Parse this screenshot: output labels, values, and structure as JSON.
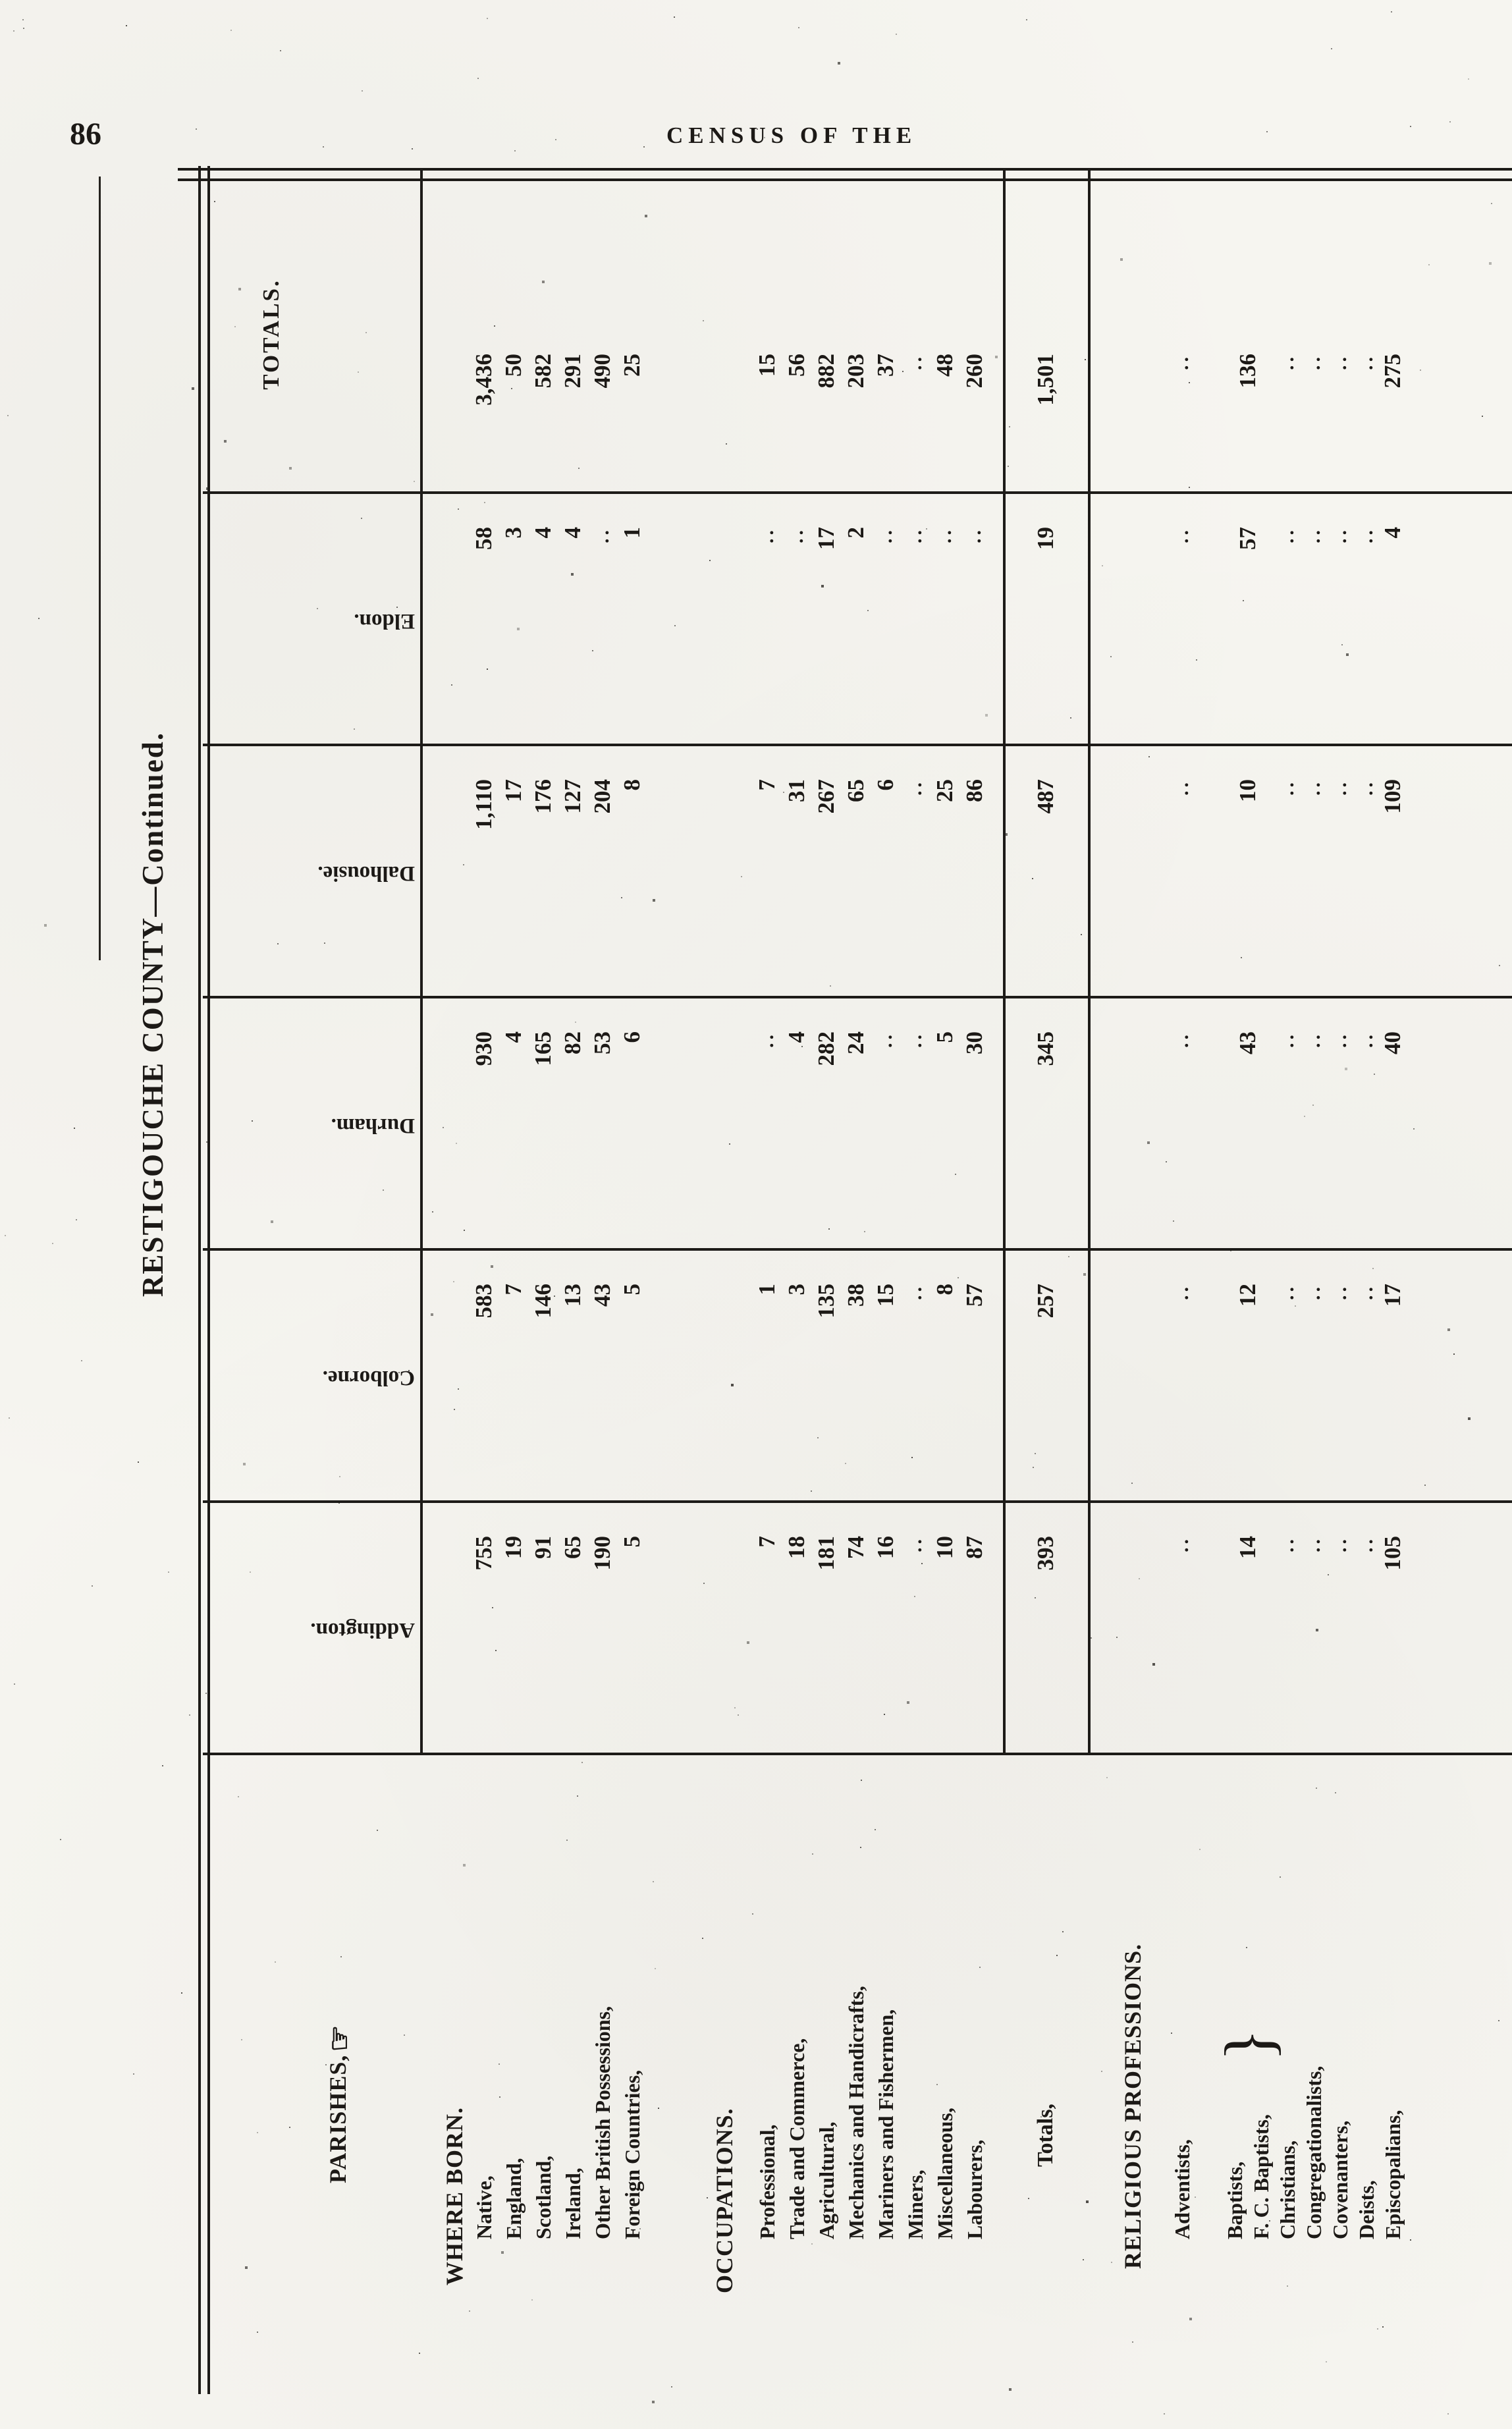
{
  "page": {
    "number": "86",
    "running_header": "CENSUS OF THE",
    "table_title": "RESTIGOUCHE COUNTY—Continued."
  },
  "table": {
    "parishes_label": "PARISHES,",
    "manicule": "☞",
    "blank_marker": "..",
    "brace_glyph": "}",
    "columns": [
      "Addington.",
      "Colborne.",
      "Durham.",
      "Dalhousie.",
      "Eldon.",
      "TOTALS."
    ],
    "sections": [
      {
        "title": "WHERE BORN.",
        "rows": [
          {
            "label": "Native,",
            "values": [
              "755",
              "583",
              "930",
              "1,110",
              "58",
              "3,436"
            ]
          },
          {
            "label": "England,",
            "values": [
              "19",
              "7",
              "4",
              "17",
              "3",
              "50"
            ]
          },
          {
            "label": "Scotland,",
            "values": [
              "91",
              "146",
              "165",
              "176",
              "4",
              "582"
            ]
          },
          {
            "label": "Ireland,",
            "values": [
              "65",
              "13",
              "82",
              "127",
              "4",
              "291"
            ]
          },
          {
            "label": "Other British Possessions,",
            "values": [
              "190",
              "43",
              "53",
              "204",
              "..",
              "490"
            ]
          },
          {
            "label": "Foreign Countries,",
            "values": [
              "5",
              "5",
              "6",
              "8",
              "1",
              "25"
            ]
          }
        ]
      },
      {
        "title": "OCCUPATIONS.",
        "rows": [
          {
            "label": "Professional,",
            "values": [
              "7",
              "1",
              "..",
              "7",
              "..",
              "15"
            ]
          },
          {
            "label": "Trade and Commerce,",
            "values": [
              "18",
              "3",
              "4",
              "31",
              "..",
              "56"
            ]
          },
          {
            "label": "Agricultural,",
            "values": [
              "181",
              "135",
              "282",
              "267",
              "17",
              "882"
            ]
          },
          {
            "label": "Mechanics and Handicrafts,",
            "values": [
              "74",
              "38",
              "24",
              "65",
              "2",
              "203"
            ]
          },
          {
            "label": "Mariners and Fishermen,",
            "values": [
              "16",
              "15",
              "..",
              "6",
              "..",
              "37"
            ]
          },
          {
            "label": "Miners,",
            "values": [
              "..",
              "..",
              "..",
              "..",
              "..",
              ".."
            ]
          },
          {
            "label": "Miscellaneous,",
            "values": [
              "10",
              "8",
              "5",
              "25",
              "..",
              "48"
            ]
          },
          {
            "label": "Labourers,",
            "values": [
              "87",
              "57",
              "30",
              "86",
              "..",
              "260"
            ]
          }
        ]
      }
    ],
    "totals_row": {
      "label": "Totals,",
      "values": [
        "393",
        "257",
        "345",
        "487",
        "19",
        "1,501"
      ]
    },
    "religious": {
      "title": "RELIGIOUS PROFESSIONS.",
      "rows": [
        {
          "label": "Adventists,",
          "values": [
            "..",
            "..",
            "..",
            "..",
            "..",
            ".."
          ]
        },
        {
          "label": "Baptists,",
          "label2": "F. C. Baptists,",
          "braced": true,
          "values": [
            "14",
            "12",
            "43",
            "10",
            "57",
            "136"
          ]
        },
        {
          "label": "Christians,",
          "values": [
            "..",
            "..",
            "..",
            "..",
            "..",
            ".."
          ]
        },
        {
          "label": "Congregationalists,",
          "values": [
            "..",
            "..",
            "..",
            "..",
            "..",
            ".."
          ]
        },
        {
          "label": "Covenanters,",
          "values": [
            "..",
            "..",
            "..",
            "..",
            "..",
            ".."
          ]
        },
        {
          "label": "Deists,",
          "values": [
            "..",
            "..",
            "..",
            "..",
            "..",
            ".."
          ]
        },
        {
          "label": "Episcopalians,",
          "values": [
            "105",
            "17",
            "40",
            "109",
            "4",
            "275"
          ]
        }
      ]
    }
  }
}
